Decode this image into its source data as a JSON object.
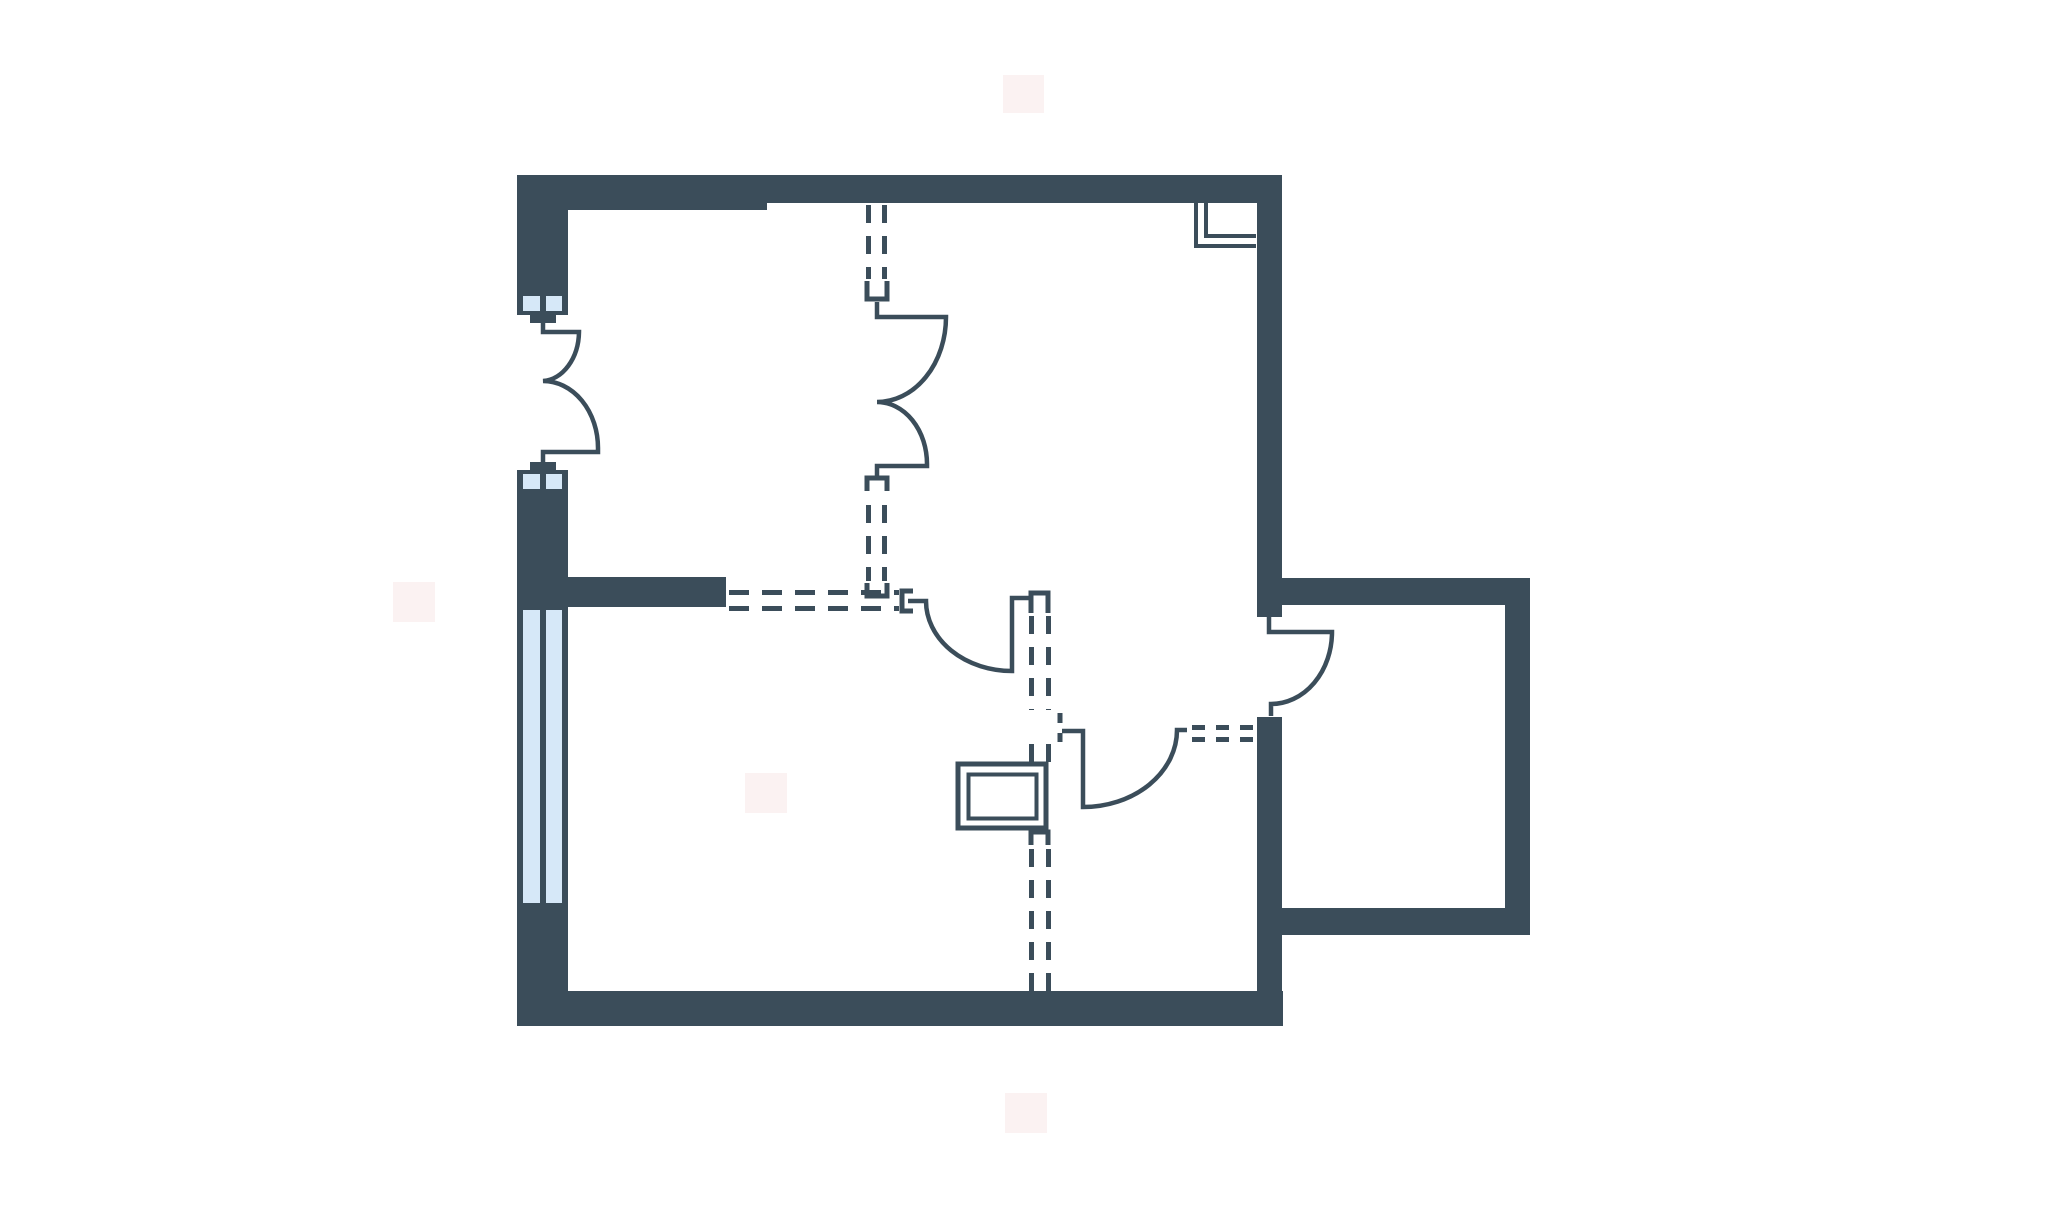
{
  "canvas": {
    "width": 2048,
    "height": 1205,
    "background": "#ffffff"
  },
  "colors": {
    "wall": "#3B4D5A",
    "line": "#3B4D5A",
    "pane": "#D6E8F8",
    "floor": "#FFFFFF",
    "watermark": "#FBF2F2"
  },
  "strokes": {
    "door": 4.5,
    "dash": 5,
    "bracket": 5,
    "fixture_outer": 5,
    "fixture_inner": 4,
    "vent": 4
  },
  "dash_patterns": {
    "wall": "18 13",
    "hwall": "20 13",
    "narrow": "13 11"
  },
  "plan": {
    "watermarks": [
      {
        "name": "watermark-top",
        "x": 1003,
        "y": 75,
        "w": 41,
        "h": 38
      },
      {
        "name": "watermark-left",
        "x": 393,
        "y": 582,
        "w": 42,
        "h": 40
      },
      {
        "name": "watermark-center",
        "x": 745,
        "y": 773,
        "w": 42,
        "h": 40
      },
      {
        "name": "watermark-bottom",
        "x": 1005,
        "y": 1093,
        "w": 42,
        "h": 40
      }
    ],
    "walls": [
      {
        "name": "top-wall-left-segment",
        "x": 517,
        "y": 175,
        "w": 250,
        "h": 35
      },
      {
        "name": "top-wall-right-segment",
        "x": 767,
        "y": 175,
        "w": 515,
        "h": 28
      },
      {
        "name": "left-wall-upper-pier",
        "x": 517,
        "y": 175,
        "w": 51,
        "h": 117
      },
      {
        "name": "left-wall-middle-pier",
        "x": 517,
        "y": 492,
        "w": 51,
        "h": 118
      },
      {
        "name": "interior-partition-wall",
        "x": 568,
        "y": 577,
        "w": 158,
        "h": 30
      },
      {
        "name": "left-wall-lower-pier",
        "x": 517,
        "y": 906,
        "w": 51,
        "h": 120
      },
      {
        "name": "bottom-wall",
        "x": 517,
        "y": 991,
        "w": 766,
        "h": 35
      },
      {
        "name": "right-wall-upper",
        "x": 1257,
        "y": 175,
        "w": 25,
        "h": 442
      },
      {
        "name": "right-wall-lower",
        "x": 1257,
        "y": 717,
        "w": 25,
        "h": 309
      },
      {
        "name": "extension-top-wall",
        "x": 1282,
        "y": 578,
        "w": 248,
        "h": 27
      },
      {
        "name": "extension-right-wall",
        "x": 1505,
        "y": 578,
        "w": 25,
        "h": 357
      },
      {
        "name": "extension-bottom-wall",
        "x": 1282,
        "y": 908,
        "w": 248,
        "h": 27
      }
    ],
    "windows": [
      {
        "name": "entry-sidelight-top",
        "frame": [
          517,
          292,
          51,
          23
        ],
        "panes": [
          [
            523,
            296,
            17,
            15
          ],
          [
            546,
            296,
            16,
            15
          ]
        ]
      },
      {
        "name": "entry-sidelight-bottom",
        "frame": [
          517,
          470,
          51,
          23
        ],
        "panes": [
          [
            523,
            474,
            17,
            15
          ],
          [
            546,
            474,
            16,
            15
          ]
        ]
      },
      {
        "name": "living-room-window",
        "frame": [
          517,
          605,
          51,
          303
        ],
        "panes": [
          [
            523,
            610,
            17,
            293
          ],
          [
            546,
            610,
            16,
            293
          ]
        ]
      }
    ],
    "door_tabs": [
      {
        "name": "entry-door-tab-top",
        "x": 530,
        "y": 313,
        "w": 26,
        "h": 10
      },
      {
        "name": "entry-door-tab-bottom",
        "x": 530,
        "y": 462,
        "w": 26,
        "h": 10
      }
    ],
    "door_swings": [
      {
        "name": "entry-double-swing-door",
        "d": "M 543 323 V 332 H 579 A 38 50 0 0 1 543 381 A 55 67 0 0 1 598 448 V 452 H 543 V 462"
      },
      {
        "name": "interior-double-swing-door",
        "d": "M 877 302 V 317 H 946 A 69 85 0 0 1 877 402 A 50 62 0 0 1 927 464 V 466 H 877 V 477"
      },
      {
        "name": "hall-door-west-swing",
        "d": "M 908 601 H 926 A 86 70 0 0 0 1012 671 V 598 H 1030"
      },
      {
        "name": "hall-door-south-swing",
        "d": "M 1062 731 H 1083 V 807 A 94 77 0 0 0 1177 730 H 1187"
      },
      {
        "name": "extension-door-swing",
        "d": "M 1269 615 V 632 H 1332 A 61 72 0 0 1 1271 704 V 716"
      }
    ],
    "brackets": [
      {
        "name": "jamb-cap-door-e-top",
        "d": "M 867 281 V 299 H 887 V 281"
      },
      {
        "name": "jamb-cap-door-e-bottom",
        "d": "M 867 491 V 478 H 887 V 491"
      },
      {
        "name": "jamb-cap-junction",
        "d": "M 867 583 V 596 H 887 V 583"
      },
      {
        "name": "jamb-cap-door-a-left",
        "d": "M 913 591 H 902 V 611 H 913"
      },
      {
        "name": "jamb-cap-dashed-wall-top",
        "d": "M 1031 613 V 593 H 1048 V 613"
      },
      {
        "name": "jamb-tick-door-b-upper",
        "d": "M 1060 713 V 723"
      },
      {
        "name": "jamb-tick-door-b-lower",
        "d": "M 1060 733 V 742"
      },
      {
        "name": "jamb-cap-below-fixture",
        "d": "M 1031 845 V 832 H 1048 V 845"
      }
    ],
    "dashed_walls": [
      {
        "name": "removed-wall-v-upper-left",
        "x1": 868.5,
        "y1": 205,
        "x2": 868.5,
        "y2": 279,
        "pattern": "wall"
      },
      {
        "name": "removed-wall-v-upper-right",
        "x1": 884.5,
        "y1": 205,
        "x2": 884.5,
        "y2": 279,
        "pattern": "wall"
      },
      {
        "name": "removed-wall-v-mid-left",
        "x1": 868.5,
        "y1": 505,
        "x2": 868.5,
        "y2": 581,
        "pattern": "wall"
      },
      {
        "name": "removed-wall-v-mid-right",
        "x1": 884.5,
        "y1": 505,
        "x2": 884.5,
        "y2": 581,
        "pattern": "wall"
      },
      {
        "name": "removed-wall-h-top-line",
        "x1": 729,
        "y1": 592.5,
        "x2": 899,
        "y2": 592.5,
        "pattern": "hwall"
      },
      {
        "name": "removed-wall-h-bottom-line",
        "x1": 729,
        "y1": 608.5,
        "x2": 899,
        "y2": 608.5,
        "pattern": "hwall"
      },
      {
        "name": "removed-wall-v2-a-left",
        "x1": 1031.5,
        "y1": 616,
        "x2": 1031.5,
        "y2": 710,
        "pattern": "wall"
      },
      {
        "name": "removed-wall-v2-a-right",
        "x1": 1048.5,
        "y1": 616,
        "x2": 1048.5,
        "y2": 710,
        "pattern": "wall"
      },
      {
        "name": "removed-wall-v2-b-left",
        "x1": 1031.5,
        "y1": 744,
        "x2": 1031.5,
        "y2": 762,
        "pattern": "wall"
      },
      {
        "name": "removed-wall-v2-b-right",
        "x1": 1048.5,
        "y1": 744,
        "x2": 1048.5,
        "y2": 762,
        "pattern": "wall"
      },
      {
        "name": "removed-wall-v2-c-left",
        "x1": 1031.5,
        "y1": 849,
        "x2": 1031.5,
        "y2": 991,
        "pattern": "wall"
      },
      {
        "name": "removed-wall-v2-c-right",
        "x1": 1048.5,
        "y1": 849,
        "x2": 1048.5,
        "y2": 991,
        "pattern": "wall"
      },
      {
        "name": "removed-wall-h2-top-line",
        "x1": 1192,
        "y1": 727.5,
        "x2": 1256,
        "y2": 727.5,
        "pattern": "narrow"
      },
      {
        "name": "removed-wall-h2-bottom-line",
        "x1": 1192,
        "y1": 739.5,
        "x2": 1256,
        "y2": 739.5,
        "pattern": "narrow"
      }
    ],
    "vent": [
      {
        "name": "duct-symbol-outer-line",
        "d": "M 1196 203 V 246 H 1256"
      },
      {
        "name": "duct-symbol-inner-line",
        "d": "M 1206 203 V 236 H 1256"
      }
    ],
    "fixture": {
      "outer": {
        "name": "fixture-outer-rect",
        "x": 958,
        "y": 764,
        "w": 88,
        "h": 64
      },
      "inner": {
        "name": "fixture-inner-rect",
        "x": 968.5,
        "y": 774.5,
        "w": 68,
        "h": 44
      }
    }
  }
}
